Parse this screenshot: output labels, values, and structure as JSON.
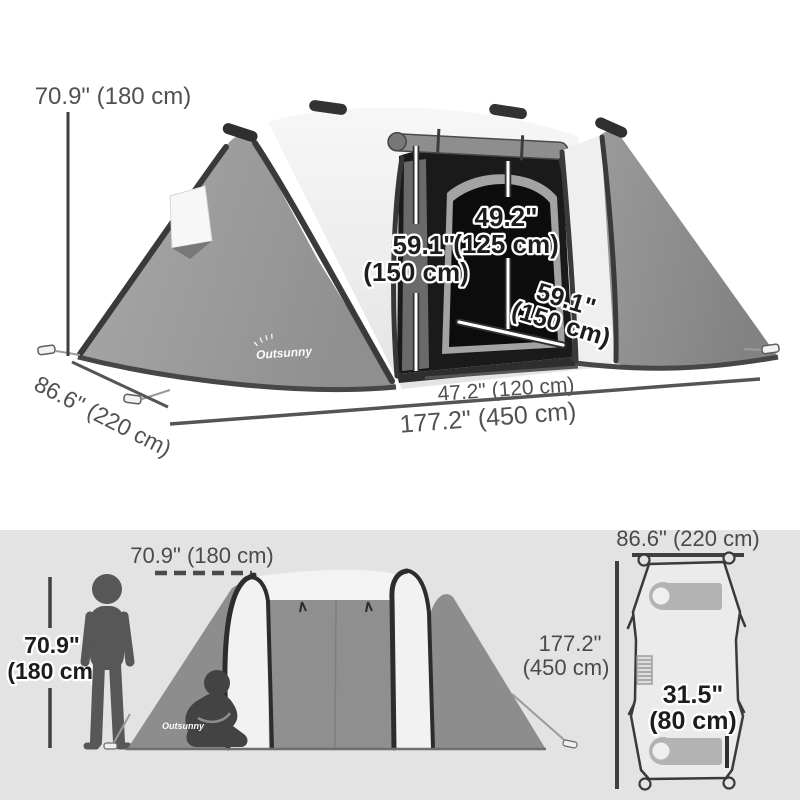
{
  "brand": "Outsunny",
  "perspective_view": {
    "tent_height": "70.9\" (180 cm)",
    "room_height_in": "59.1\"",
    "room_height_cm": "(150 cm)",
    "door_height_in": "49.2\"",
    "door_height_cm": "(125 cm)",
    "room_depth_in": "59.1\"",
    "room_depth_cm": "(150 cm)",
    "center_width": "47.2\" (120 cm)",
    "total_length": "177.2\" (450 cm)",
    "tent_depth": "86.6\" (220 cm)"
  },
  "side_view": {
    "ridge_height": "70.9\" (180 cm)",
    "person_height_in": "70.9\"",
    "person_height_cm": "(180 cm)"
  },
  "top_view": {
    "tent_width": "86.6\" (220 cm)",
    "tent_length_in": "177.2\"",
    "tent_length_cm": "(450 cm)",
    "inner_width_in": "31.5\"",
    "inner_width_cm": "(80 cm)"
  },
  "colors": {
    "panel_background": "#e3e3e3",
    "fabric_gray": "#949494",
    "fabric_light": "#f3f3f3",
    "pole_dark": "#333333",
    "label_gray": "#515151",
    "silhouette_gray": "#545454"
  }
}
